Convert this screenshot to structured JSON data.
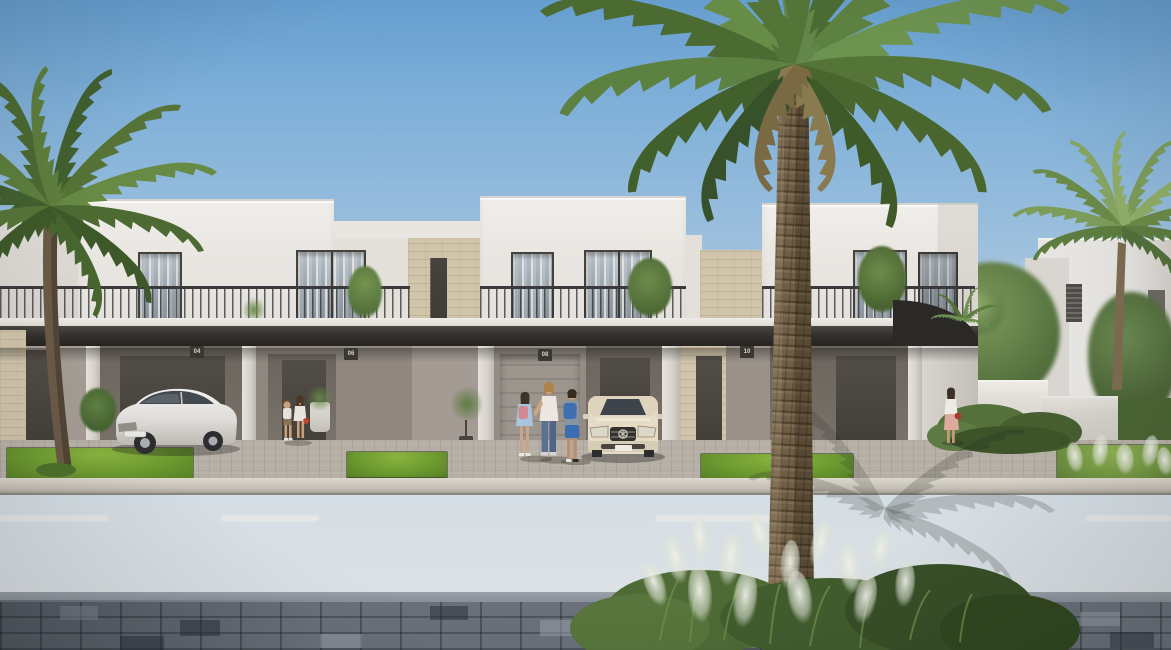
{
  "scene": {
    "title": "Sunny street view of modern white two-storey townhouses with palm trees",
    "setting": "Real-estate architectural rendering: row of flat-roofed townhouses with dark canopy band, balconies with metal railings, beige stone accent recesses, paver driveways, asphalt road and blue-grey paver sidewalk in the foreground",
    "house_numbers": [
      "04",
      "06",
      "08",
      "10"
    ]
  },
  "objects": {
    "left_car": "white sedan parked under carport",
    "center_car": "beige Mercedes sedan parked in driveway",
    "family_group": "woman with two children standing in driveway",
    "toddler_group": "two small children playing by an entry porch",
    "right_pedestrian": "woman in white top and cream skirt walking near garden wall",
    "left_palm": "date palm in front of left unit",
    "center_palm": "tall date palm in front of right unit",
    "right_palm": "background palm near distant villa",
    "ornamental_grasses": "white-plumed fountain grasses in foreground bed"
  },
  "colors": {
    "sky_top": "#669ecf",
    "sky_horizon": "#e0e4e6",
    "building_white": "#eceae6",
    "stone_accent": "#d0c4aa",
    "canopy_dark": "#2a2825",
    "grass_green": "#6d9a30",
    "road_asphalt": "#6f6f6e",
    "paver_blue_grey": "#6b717a",
    "palm_green": "#5d8141",
    "trunk_brown": "#6f5d45"
  }
}
